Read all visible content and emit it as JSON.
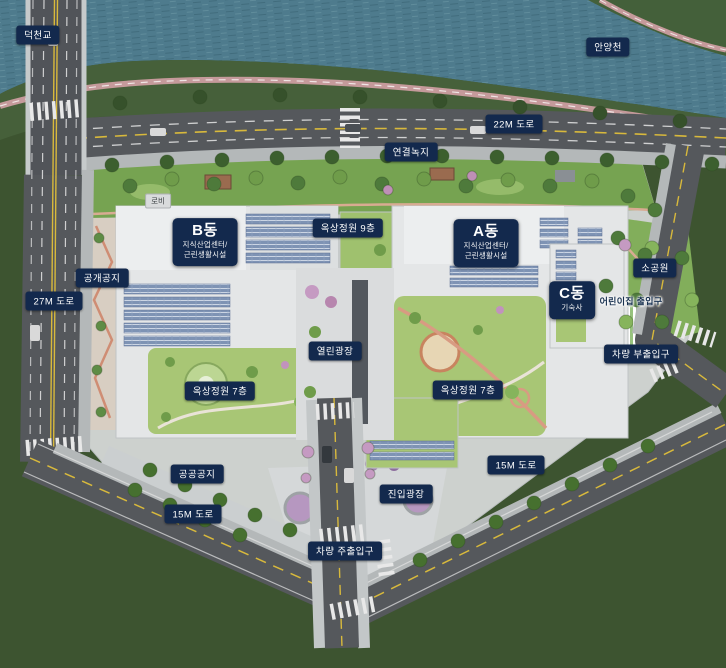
{
  "colors": {
    "water": "#4e7b8d",
    "river_bank_green": "#46603a",
    "field_green": "#3d5430",
    "site_lawn": "#a8c675",
    "road_gray": "#55585c",
    "sidewalk_gray": "#b4b8b9",
    "bike_path_pink": "#c59a9b",
    "label_navy": "#13294d",
    "building_roof": "#e4e6e7",
    "solar_panel_blue": "#7e93b4",
    "accent_path": "#d89b82"
  },
  "labels": {
    "bridge": "덕천교",
    "river": "안양천",
    "road_22m": "22M 도로",
    "road_27m": "27M 도로",
    "road_15m_left": "15M 도로",
    "road_15m_right": "15M 도로",
    "green_link": "연결녹지",
    "lobby": "로비",
    "rooftop_garden_9f": "옥상정원 9층",
    "rooftop_garden_7f_left": "옥상정원 7층",
    "rooftop_garden_7f_right": "옥상정원 7층",
    "small_park": "소공원",
    "public_open_space": "공개공지",
    "public_land": "공공공지",
    "open_plaza": "열린광장",
    "entry_plaza": "진입광장",
    "daycare_entrance": "어린이집 출입구",
    "vehicle_main_entrance": "차량 주출입구",
    "vehicle_sub_entrance": "차량 부출입구"
  },
  "buildings": {
    "a": {
      "name": "A동",
      "line1": "지식산업센터/",
      "line2": "근린생활시설"
    },
    "b": {
      "name": "B동",
      "line1": "지식산업센터/",
      "line2": "근린생활시설"
    },
    "c": {
      "name": "C동",
      "line1": "기숙사"
    }
  }
}
